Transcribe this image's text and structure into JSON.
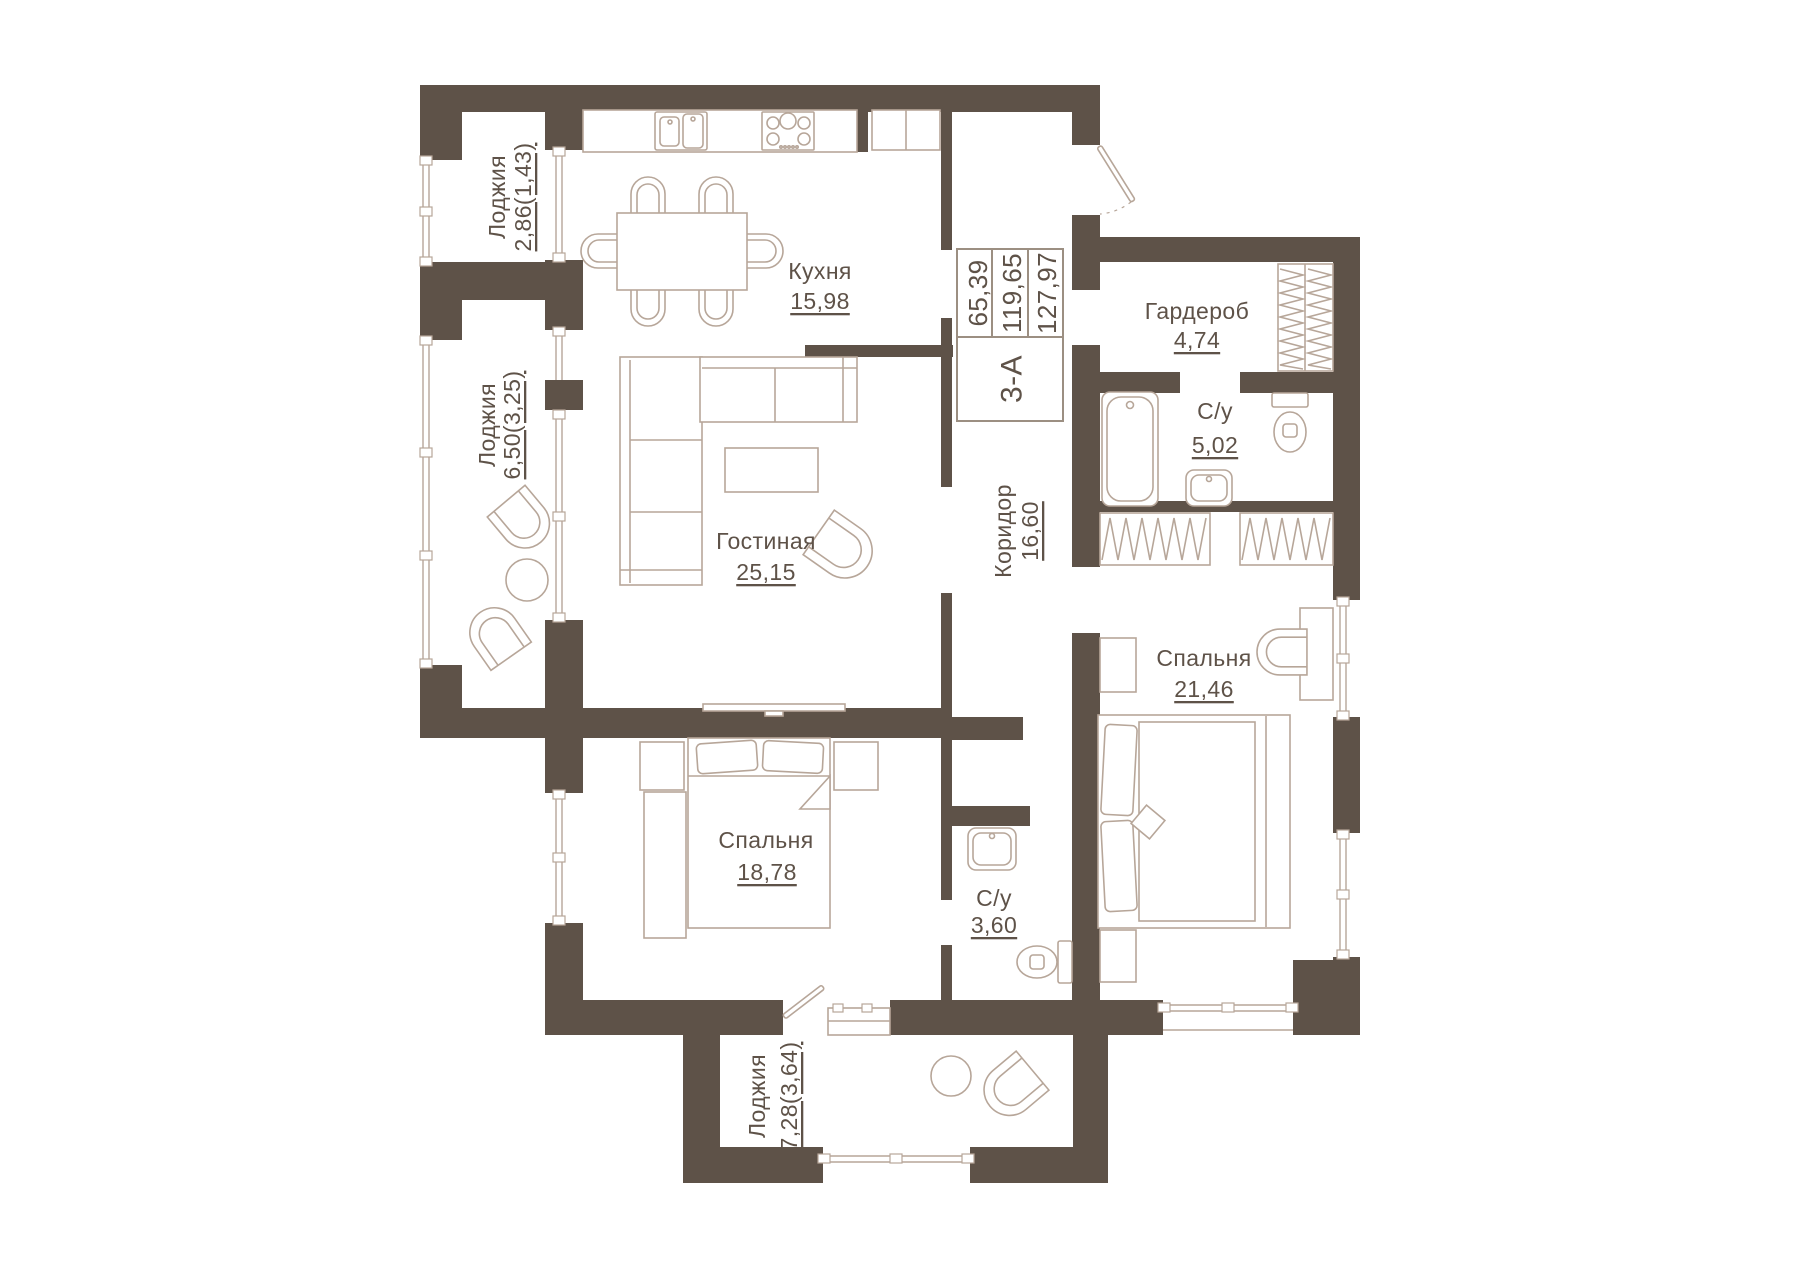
{
  "plan": {
    "stamp": {
      "total_area": "65,39",
      "living_area": "119,65",
      "full_area": "127,97",
      "unit_type": "3-А"
    },
    "rooms": {
      "loggia_top": {
        "name": "Лоджия",
        "area": "2,86(1,43)"
      },
      "loggia_left": {
        "name": "Лоджия",
        "area": "6,50(3,25)"
      },
      "kitchen": {
        "name": "Кухня",
        "area": "15,98"
      },
      "living": {
        "name": "Гостиная",
        "area": "25,15"
      },
      "corridor": {
        "name": "Коридор",
        "area": "16,60"
      },
      "wardrobe": {
        "name": "Гардероб",
        "area": "4,74"
      },
      "bathroom_main": {
        "name": "С/у",
        "area": "5,02"
      },
      "bedroom_right": {
        "name": "Спальня",
        "area": "21,46"
      },
      "bedroom_left": {
        "name": "Спальня",
        "area": "18,78"
      },
      "bathroom_small": {
        "name": "С/у",
        "area": "3,60"
      },
      "loggia_bottom": {
        "name": "Лоджия",
        "area": "7,28(3,64)"
      }
    },
    "colors": {
      "wall": "#5e5248",
      "furniture_line": "#b7a699",
      "label_text": "#5e5248",
      "stamp_border": "#9c8f82",
      "background": "#ffffff"
    }
  }
}
